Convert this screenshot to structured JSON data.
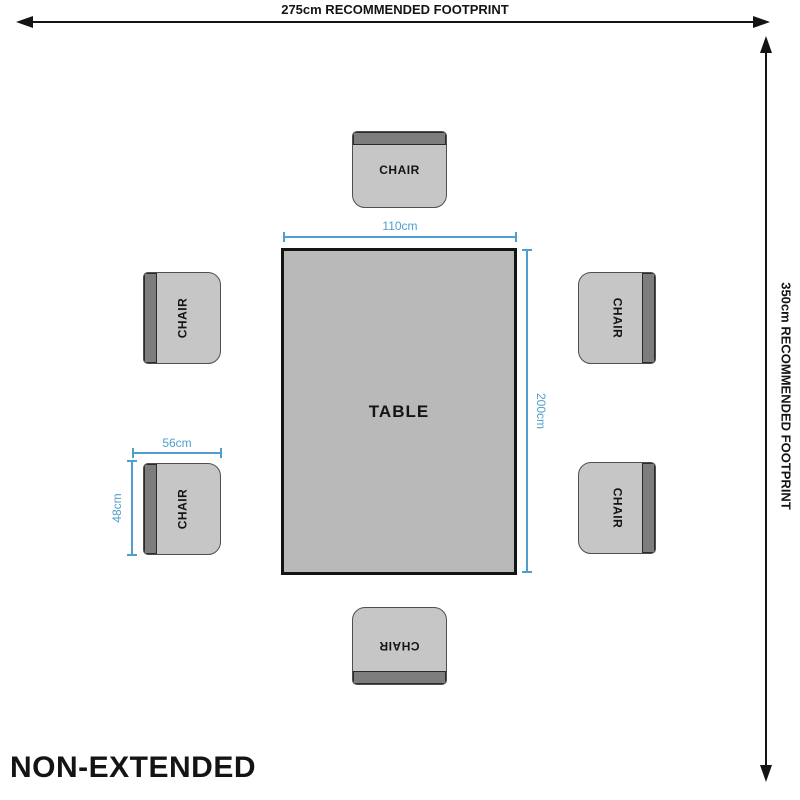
{
  "colors": {
    "ink": "#141414",
    "dimension_blue": "#4e9fcd",
    "table_fill": "#b9b9b9",
    "chair_fill": "#c6c6c6",
    "backrest_fill": "#7d7d7d"
  },
  "footprint": {
    "horizontal_label": "275cm RECOMMENDED FOOTPRINT",
    "vertical_label": "350cm RECOMMENDED FOOTPRINT"
  },
  "table": {
    "label": "TABLE",
    "width": "110cm",
    "depth": "200cm"
  },
  "chair": {
    "label": "CHAIR",
    "width": "56cm",
    "depth": "48cm",
    "count": 6
  },
  "caption": "NON-EXTENDED"
}
